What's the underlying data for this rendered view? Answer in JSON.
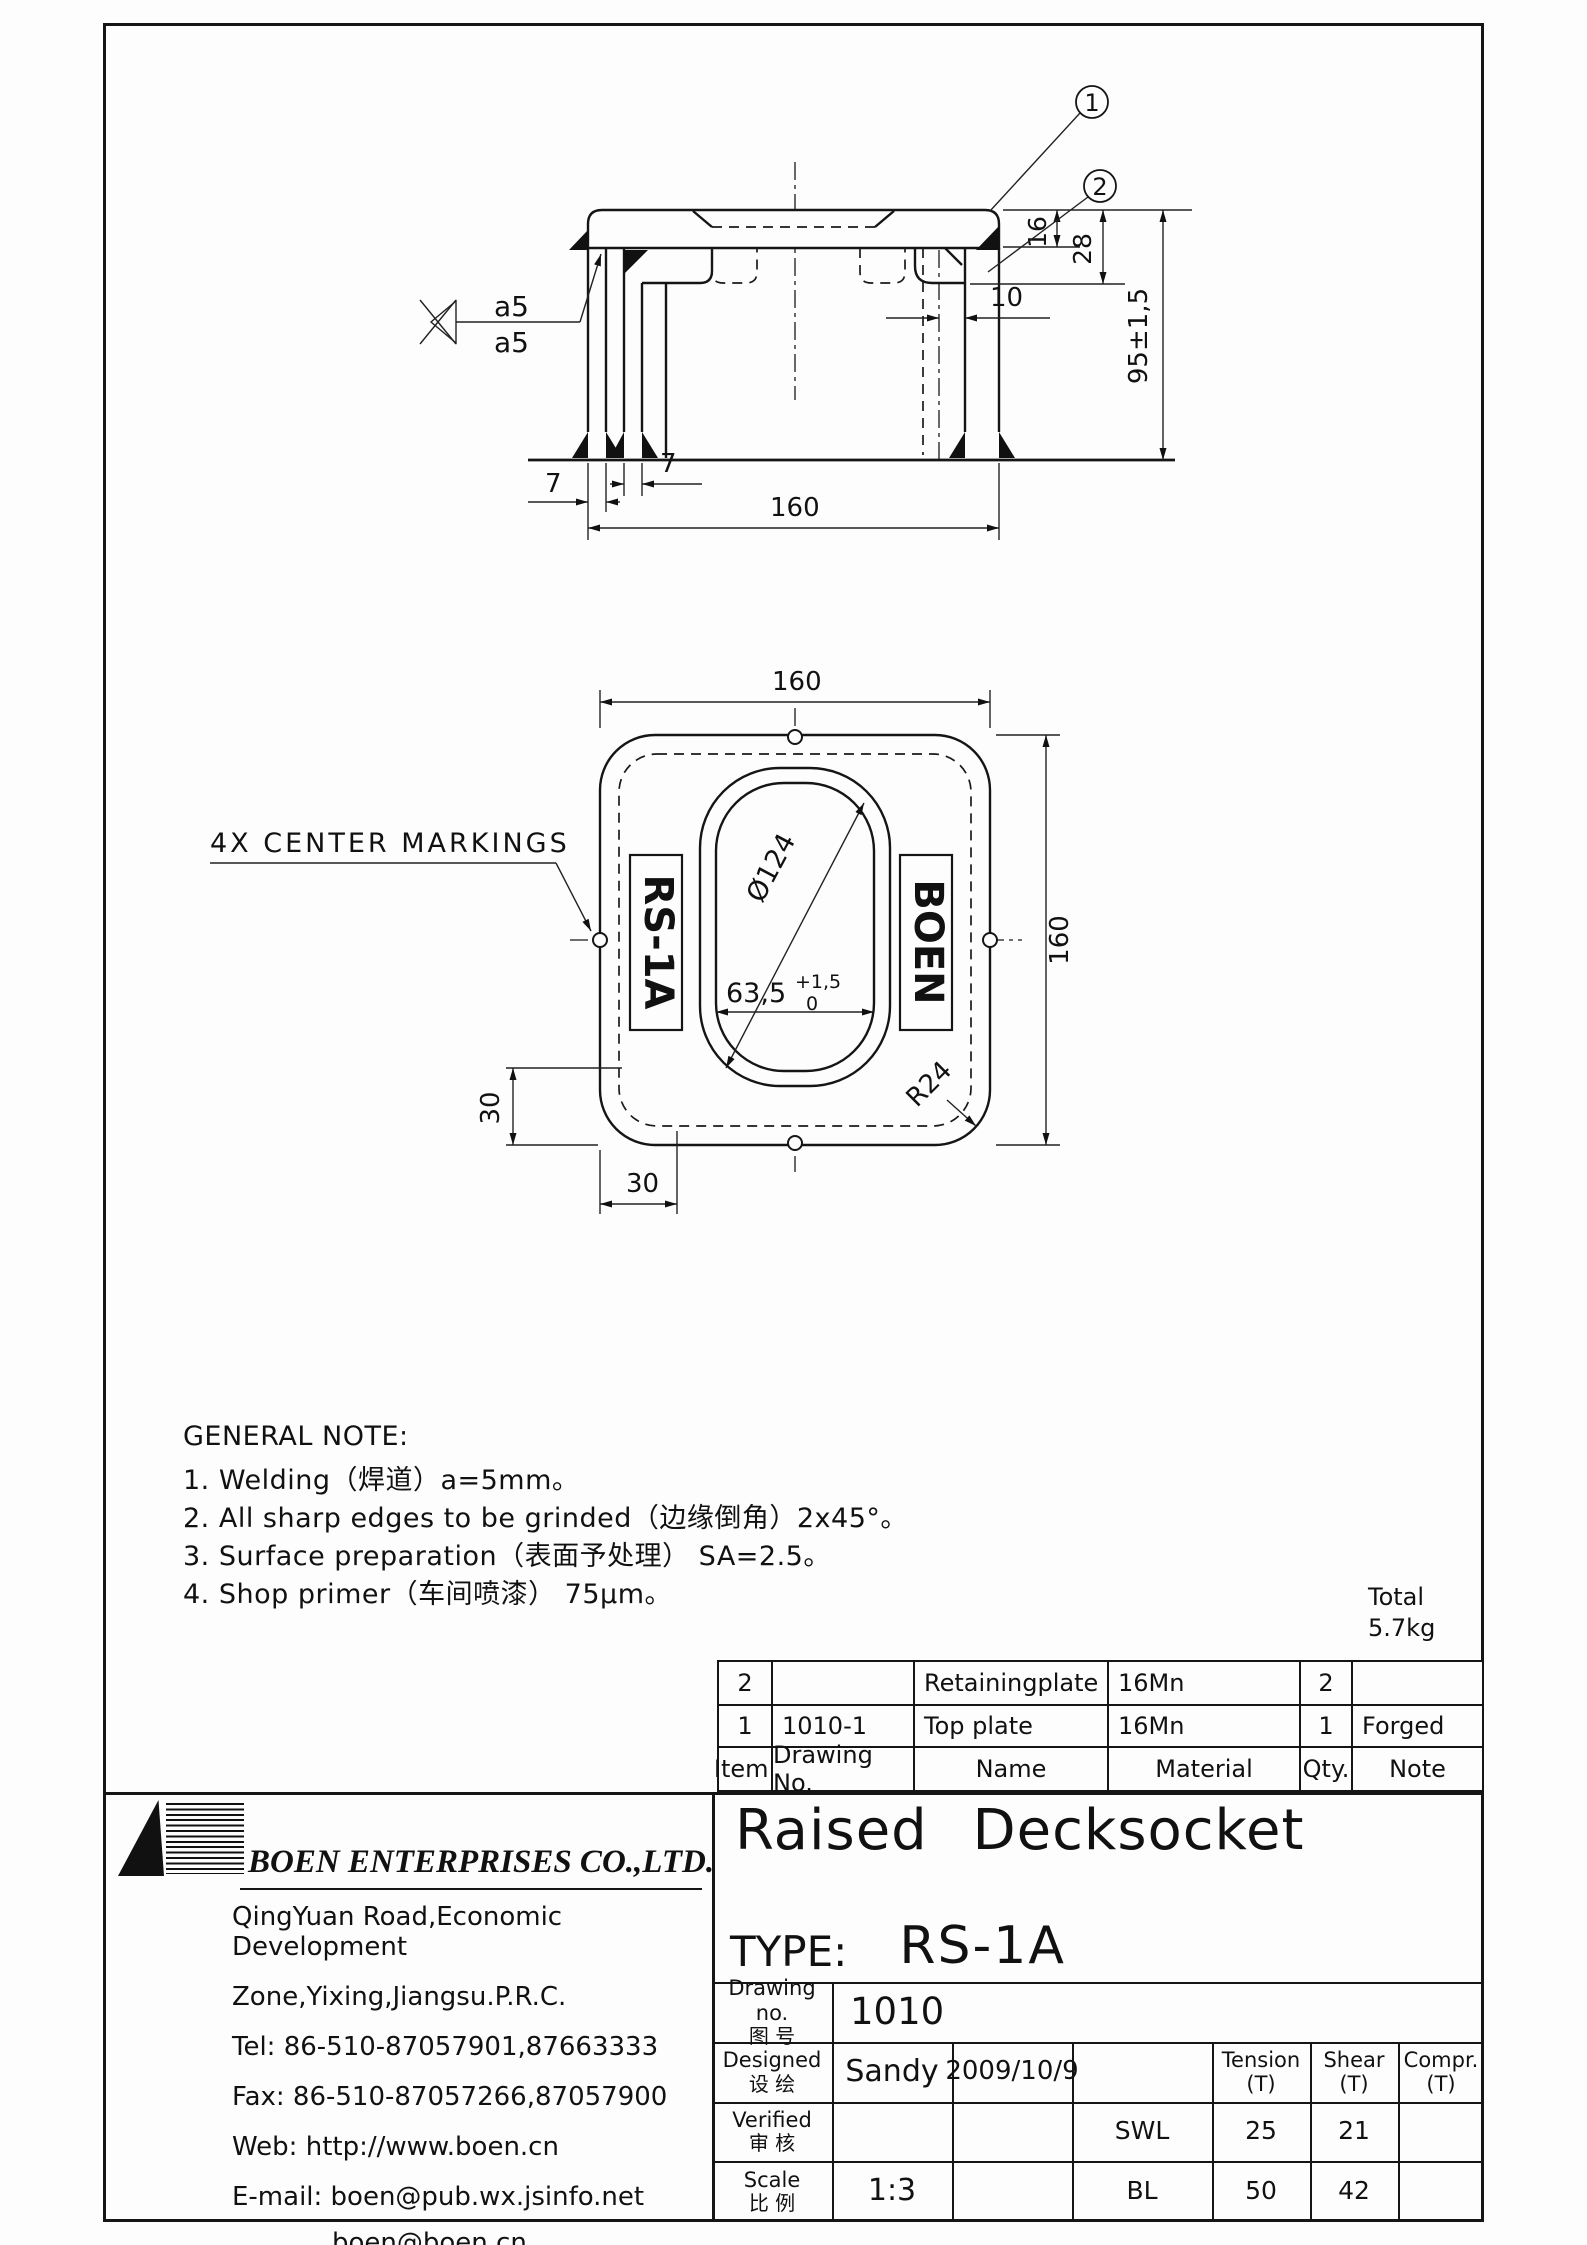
{
  "side_view": {
    "balloons": {
      "b1": "1",
      "b2": "2"
    },
    "weld": {
      "top": "a5",
      "bottom": "a5"
    },
    "dims": {
      "t16": "16",
      "t28": "28",
      "t10": "10",
      "h95": "95±1,5",
      "b7l": "7",
      "b7r": "7",
      "w160": "160"
    }
  },
  "top_view": {
    "callout": "4X CENTER MARKINGS",
    "stamp_left": "RS-1A",
    "stamp_right": "BOEN",
    "dims": {
      "top160": "160",
      "right160": "160",
      "dia": "Ø124",
      "slot": "63,5",
      "tol_plus": "+1,5",
      "tol_zero": "0",
      "r24": "R24",
      "v30": "30",
      "h30": "30"
    }
  },
  "notes": {
    "title": "GENERAL NOTE:",
    "items": [
      "1. Welding（焊道）a=5mm。",
      "2. All sharp edges to be grinded（边缘倒角）2x45°。",
      "3. Surface preparation（表面予处理） SA=2.5。",
      "4. Shop primer（车间喷漆） 75μm。"
    ]
  },
  "weight": {
    "label": "Total",
    "value": "5.7kg"
  },
  "parts_table": {
    "headers": {
      "item": "Item.",
      "drawing_no": "Drawing No.",
      "name": "Name",
      "material": "Material",
      "qty": "Qty.",
      "note": "Note"
    },
    "rows": [
      {
        "item": "2",
        "drawing_no": "",
        "name": "Retainingplate",
        "material": "16Mn",
        "qty": "2",
        "note": ""
      },
      {
        "item": "1",
        "drawing_no": "1010-1",
        "name": "Top plate",
        "material": "16Mn",
        "qty": "1",
        "note": "Forged"
      }
    ]
  },
  "company": {
    "name": "BOEN ENTERPRISES CO.,LTD.",
    "address1": "QingYuan Road,Economic Development",
    "address2": "Zone,Yixing,Jiangsu.P.R.C.",
    "tel": "Tel: 86-510-87057901,87663333",
    "fax": "Fax: 86-510-87057266,87057900",
    "web": "Web: http://www.boen.cn",
    "email": "E-mail: boen@pub.wx.jsinfo.net",
    "email2": "boen@boen.cn"
  },
  "title_block": {
    "title": "Raised Decksocket",
    "type_label": "TYPE:",
    "type_value": "RS-1A",
    "drawing_no_label_en": "Drawing no.",
    "drawing_no_label_cn": "图 号",
    "drawing_no_value": "1010",
    "designed_en": "Designed",
    "designed_cn": "设 绘",
    "designer": "Sandy",
    "date": "2009/10/9",
    "verified_en": "Verified",
    "verified_cn": "审 核",
    "scale_en": "Scale",
    "scale_cn": "比 例",
    "scale_value": "1:3",
    "tension_label": "Tension",
    "shear_label": "Shear",
    "compr_label": "Compr.",
    "unit": "(T)",
    "swl_label": "SWL",
    "swl_tension": "25",
    "swl_shear": "21",
    "bl_label": "BL",
    "bl_tension": "50",
    "bl_shear": "42"
  }
}
